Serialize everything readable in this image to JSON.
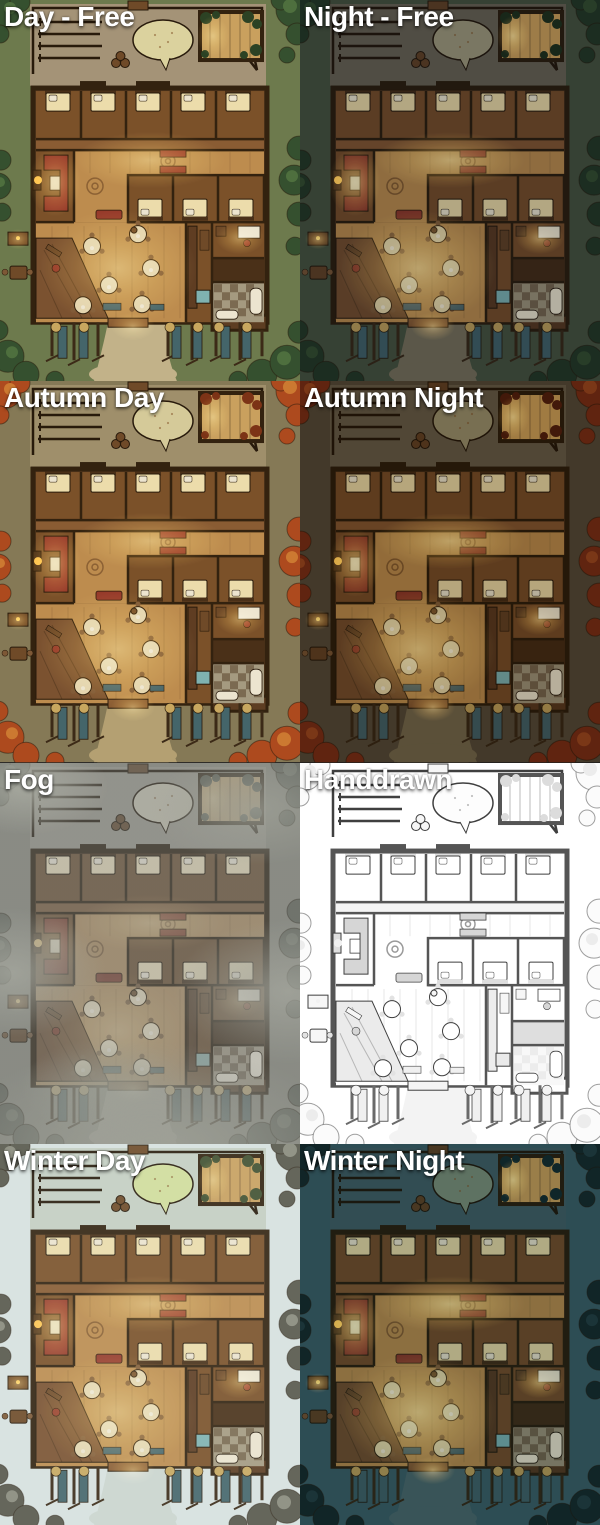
{
  "page": {
    "description": "Preview sheet of one tavern battle map rendered in eight variants",
    "grid": {
      "columns": 2,
      "rows": 4
    },
    "label_text_color": "#ffffff"
  },
  "tiles": [
    {
      "id": "day-free",
      "label": "Day - Free",
      "effect": "none",
      "palette": {}
    },
    {
      "id": "night-free",
      "label": "Night - Free",
      "effect": "night",
      "palette": {
        "grass": "#3e4936",
        "yard": "#5e5749",
        "path": "#6b644f",
        "sand": "#8f8a6e",
        "tree": "#20311f",
        "tree2": "#2e4428",
        "plant": "#1b2a16",
        "crate": "#573a1f",
        "pav": "#b98f4e",
        "wall": "#271a0a",
        "line": "#1f1408",
        "base": "#4e321b",
        "room": "#6a4423",
        "corr": "#764d2a",
        "hall": "#a87c43",
        "deck": "#684527",
        "carpet": "#7f3123",
        "bed": "#d3c393",
        "decal": "#775129",
        "table": "#cabc92",
        "chair": "#6a4a2d",
        "counter": "#50331c",
        "basin": "#6fa0a0",
        "paper": "#d5cdb8",
        "tile": "#8d836c",
        "dark2": "#3d2713",
        "trough": "#3a565c",
        "stall": "#312313",
        "hay": "#ab8e4f",
        "glow": "0.7"
      }
    },
    {
      "id": "autumn-day",
      "label": "Autumn Day",
      "effect": "none",
      "palette": {
        "grass": "#857956",
        "yard": "#9f8f6b",
        "path": "#b4a072",
        "sand": "#d5ca99",
        "tree": "#ad4a1e",
        "tree2": "#cc7931",
        "plant": "#7c3316"
      }
    },
    {
      "id": "autumn-night",
      "label": "Autumn Night",
      "effect": "autumn-night",
      "palette": {
        "grass": "#4b4131",
        "yard": "#5b5140",
        "path": "#675c43",
        "sand": "#898161",
        "tree": "#6d2812",
        "tree2": "#8c3e1b",
        "plant": "#491b0b",
        "crate": "#573a1f",
        "pav": "#b98f4e",
        "wall": "#271a0a",
        "line": "#1f1408",
        "base": "#4e321b",
        "room": "#6a4423",
        "corr": "#764d2a",
        "hall": "#a87c43",
        "deck": "#684527",
        "carpet": "#7f3123",
        "bed": "#d3c393",
        "decal": "#775129",
        "table": "#cabc92",
        "chair": "#6a4a2d",
        "counter": "#50331c",
        "basin": "#6fa0a0",
        "paper": "#d5cdb8",
        "tile": "#8d836c",
        "dark2": "#3d2713",
        "trough": "#3a565c",
        "stall": "#312313",
        "hay": "#ab8e4f",
        "glow": "0.7"
      }
    },
    {
      "id": "fog",
      "label": "Fog",
      "effect": "fog",
      "palette": {
        "grass": "#898c80",
        "yard": "#9a988c",
        "path": "#aaa89b",
        "sand": "#c5c0aa",
        "tree": "#5d665a",
        "tree2": "#717a6c",
        "plant": "#525a4e",
        "glow": "0.4"
      }
    },
    {
      "id": "handdrawn",
      "label": "Handdrawn",
      "effect": "none",
      "palette": {
        "grass": "#ffffff",
        "yard": "#ffffff",
        "path": "#f3f3f3",
        "sand": "#fdfdfd",
        "tree": "#fbfbfb",
        "tree2": "#ececec",
        "plant": "#dcdcdc",
        "crate": "#f6f6f6",
        "pav": "#ffffff",
        "wall": "#555555",
        "line": "#3f3f3f",
        "base": "#ffffff",
        "room": "#ffffff",
        "corr": "#f4f4f4",
        "hall": "#ffffff",
        "deck": "#ebebeb",
        "carpet": "#d6d6d6",
        "fire": "#f1f1f1",
        "bed": "#ffffff",
        "decal": "#9a9a9a",
        "table": "#ffffff",
        "chair": "#e2e2e2",
        "counter": "#ededed",
        "basin": "#eaeaea",
        "paper": "#ffffff",
        "tile": "#f8f8f8",
        "dark2": "#dedede",
        "trough": "#f0f0f0",
        "stall": "#6a6a6a",
        "hay": "#f4f4f4",
        "glow": "0"
      }
    },
    {
      "id": "winter-day",
      "label": "Winter Day",
      "effect": "winter-day",
      "palette": {
        "grass": "#d8e1df",
        "yard": "#c6cec2",
        "path": "#ccd5cf",
        "sand": "#d2dd9b",
        "tree": "#57564a",
        "tree2": "#8a897b",
        "plant": "#41502f",
        "glow": "0.5"
      }
    },
    {
      "id": "winter-night",
      "label": "Winter Night",
      "effect": "winter-night",
      "palette": {
        "grass": "#35535b",
        "yard": "#3c5459",
        "path": "#445c5f",
        "sand": "#70806c",
        "tree": "#142325",
        "tree2": "#203639",
        "plant": "#122527",
        "crate": "#573a1f",
        "pav": "#b98f4e",
        "wall": "#271a0a",
        "line": "#1f1408",
        "base": "#4e321b",
        "room": "#6a4423",
        "corr": "#764d2a",
        "hall": "#a87c43",
        "deck": "#684527",
        "carpet": "#7f3123",
        "bed": "#d3c393",
        "decal": "#775129",
        "table": "#cabc92",
        "chair": "#6a4a2d",
        "counter": "#50331c",
        "basin": "#6fa0a0",
        "paper": "#d5cdb8",
        "tile": "#8d836c",
        "dark2": "#3d2713",
        "trough": "#3a565c",
        "stall": "#312313",
        "hay": "#ab8e4f",
        "glow": "0.75"
      }
    }
  ],
  "base_palette": {
    "grass": "#6d7a4d",
    "yard": "#a49377",
    "path": "#c2b289",
    "sand": "#dbd29e",
    "tree": "#35502f",
    "tree2": "#4e6f3e",
    "plant": "#2c4224",
    "crate": "#6f4a28",
    "pav": "#c9a05e",
    "wall": "#33220f",
    "line": "#281a0b",
    "base": "#5d3d22",
    "room": "#7b5129",
    "corr": "#8a5c33",
    "hall": "#bd8c4e",
    "deck": "#7b5230",
    "carpet": "#963a2a",
    "fire": "#ffc14d",
    "bed": "#ecdcab",
    "decal": "#8c6134",
    "table": "#e3d4ae",
    "chair": "#7d5836",
    "counter": "#5f3d22",
    "basin": "#7fb2b0",
    "paper": "#ece4cf",
    "tile": "#a59a80",
    "dark2": "#4a3018",
    "trough": "#44656a",
    "stall": "#3c2a17",
    "hay": "#c8a75f",
    "glow": "0.55"
  }
}
